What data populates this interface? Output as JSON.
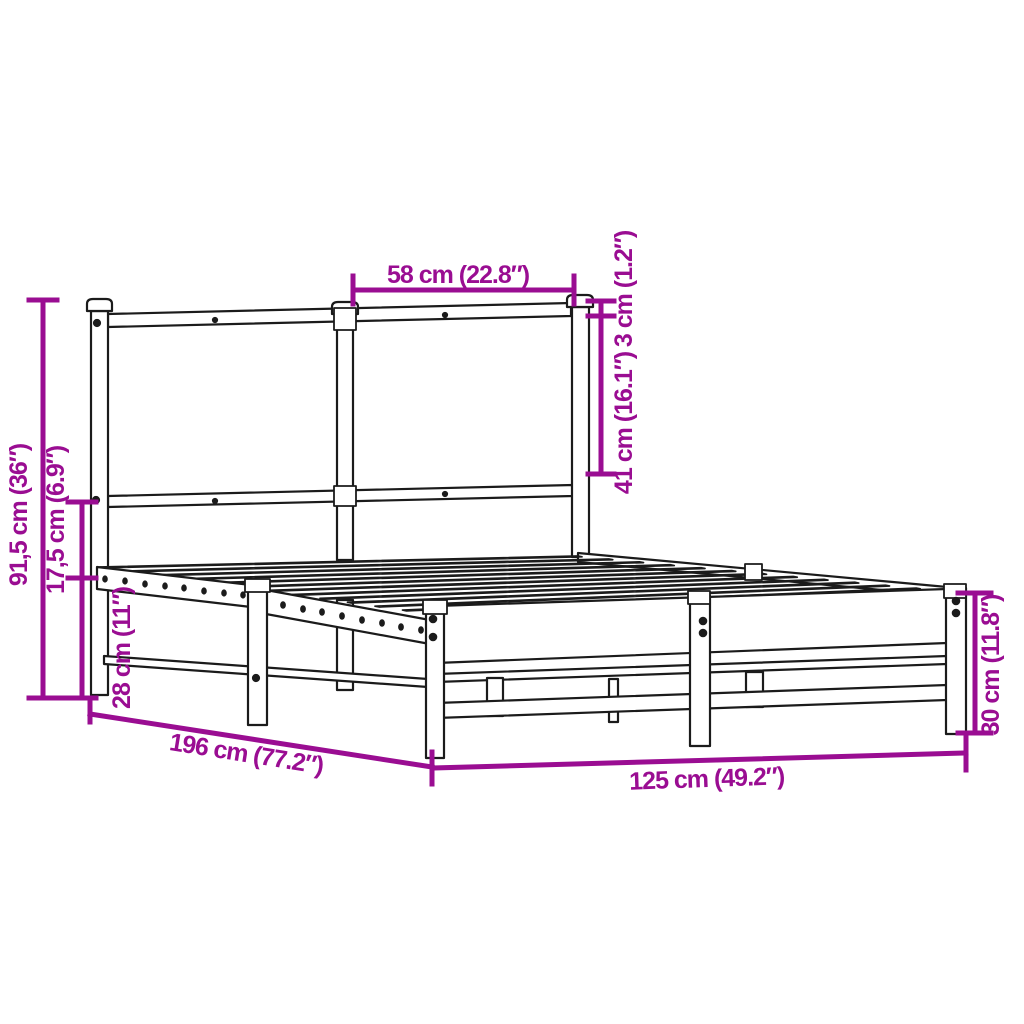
{
  "diagram": {
    "kind": "product-dimension-diagram",
    "subject": "metal-bed-frame-with-headboard",
    "background_color": "#ffffff",
    "outline_color": "#1b1b1b",
    "accent_color": "#9A0D92",
    "dimensions": {
      "headboard_panel_width": "58 cm (22.8″)",
      "post_cap_offset": "3 cm (1.2″)",
      "headboard_panel_height": "41 cm (16.1″)",
      "total_height": "91,5 cm (36″)",
      "side_rail_height": "17,5 cm (6.9″)",
      "under_bed_clearance": "28 cm (11″)",
      "bed_length": "196 cm (77.2″)",
      "bed_width": "125 cm (49.2″)",
      "frame_height": "30 cm (11.8″)"
    }
  }
}
